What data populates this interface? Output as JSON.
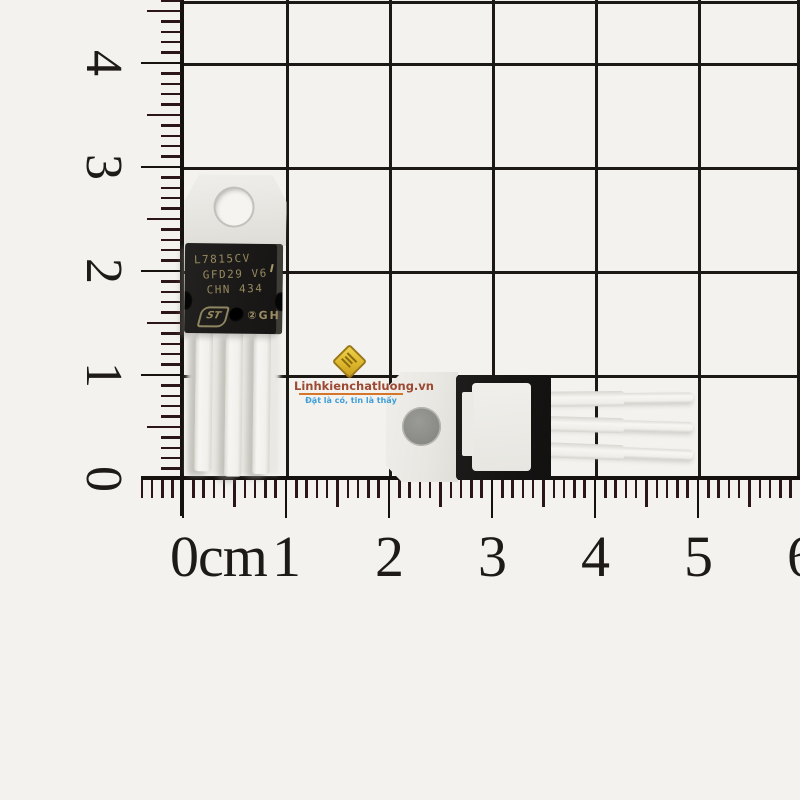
{
  "rulers": {
    "left_labels": [
      "4",
      "3",
      "2",
      "1",
      "0"
    ],
    "bottom_labels": [
      "0cm",
      "1",
      "2",
      "3",
      "4",
      "5",
      "6"
    ]
  },
  "chip": {
    "line1": "L7815CV",
    "line2": "GFD29 V6",
    "line3": "CHN 434",
    "logo": "ST",
    "marking": "②GH"
  },
  "watermark": {
    "site": "Linhkienchatluong.vn",
    "slogan": "Đặt là có, tin là thấy"
  },
  "colors": {
    "paper": "#f3f2ef",
    "grid_line": "#1c1813",
    "chip_body": "#1a1918",
    "chip_text": "#96895e",
    "metal_tab": "#eceae6",
    "lead_metal": "#f2f1ee",
    "watermark_site": "#9c4a33",
    "watermark_slogan": "#3f9fd8",
    "watermark_gold": "#dcb52a"
  }
}
